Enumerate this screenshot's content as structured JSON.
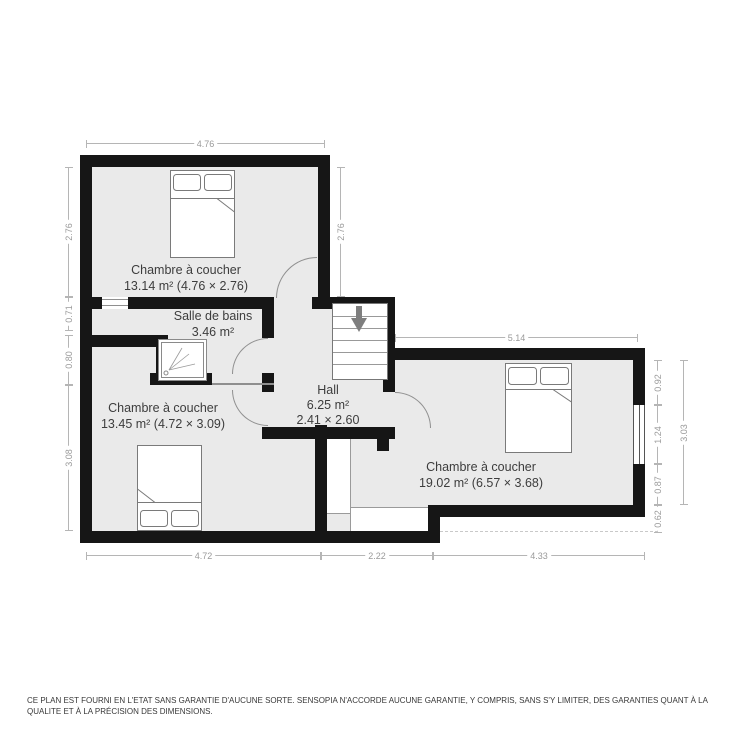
{
  "rooms": {
    "bedroom_top_left": {
      "name": "Chambre à coucher",
      "details": "13.14 m² (4.76 × 2.76)"
    },
    "bathroom": {
      "name": "Salle de bains",
      "details": "3.46 m²"
    },
    "hall": {
      "name": "Hall",
      "area": "6.25 m²",
      "size": "2.41 × 2.60"
    },
    "bedroom_bottom_left": {
      "name": "Chambre à coucher",
      "details": "13.45 m² (4.72 × 3.09)"
    },
    "bedroom_right": {
      "name": "Chambre à coucher",
      "details": "19.02 m² (6.57 × 3.68)"
    }
  },
  "dims": {
    "top_width": "4.76",
    "left_top": "2.76",
    "left_upper_mid": "0.71",
    "left_lower_mid": "0.80",
    "left_bottom": "3.08",
    "inner_right_of_room_a": "2.76",
    "right_room_width": "5.14",
    "right_seg_top": "0.92",
    "right_window": "1.24",
    "right_seg_bottom": "0.87",
    "right_offset": "0.62",
    "right_total": "3.03",
    "bottom_left": "4.72",
    "bottom_mid": "2.22",
    "bottom_right": "4.33"
  },
  "icons": {
    "beds": "double-bed",
    "shower": "shower",
    "stairs": "staircase-down-arrow"
  },
  "colors": {
    "wall": "#161616",
    "floor": "#eaeaea",
    "dimension": "#9a9a9a",
    "label": "#3d3d3d"
  },
  "footer": {
    "disclaimer": "CE PLAN EST FOURNI EN L'ETAT SANS GARANTIE D'AUCUNE SORTE. SENSOPIA N'ACCORDE AUCUNE GARANTIE, Y COMPRIS, SANS S'Y LIMITER, DES GARANTIES QUANT À LA QUALITE ET À LA PRÉCISION DES DIMENSIONS."
  }
}
